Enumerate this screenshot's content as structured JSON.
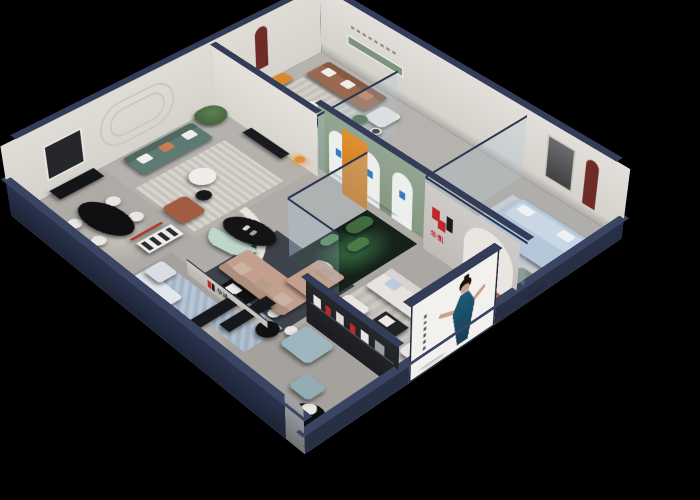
{
  "meta": {
    "description": "Isometric cutaway 3D rendering of a furniture showroom interior at night on a black background",
    "background": "#000000"
  },
  "brand": {
    "name": "华凯",
    "logo_mark": "stylized H of red and black blocks",
    "logo_red": "#c0272d",
    "logo_dark": "#1a1a1d"
  },
  "texts": {
    "brand": "华凯"
  },
  "palette": {
    "outer_wall_navy": "#272f45",
    "wall_top_navy": "#333d59",
    "interior_wall": "#ddd9d3",
    "floor_gray": "#a8a5a0",
    "green_arch_wall": "#8b9e8b",
    "maroon_niche": "#6f2b26",
    "accent_orange": "#e09030",
    "plant_green": "#4c6b45",
    "brown_leather": "#9a6a50",
    "tan_fabric": "#c2a08d",
    "teal_sofa": "#5f7a74",
    "terracotta_sofa": "#b0604a",
    "light_blue_bed": "#b5c8da",
    "cream_sofa": "#e7e4df",
    "glass": "rgba(172,198,216,0.24)"
  },
  "rooms": [
    {
      "name": "back-right lounge",
      "furniture": [
        "brown leather sofa",
        "white armchair",
        "orange accent chair",
        "round coffee tables",
        "plant",
        "green recessed wall shelf",
        "wall slogan"
      ]
    },
    {
      "name": "glass bedroom",
      "furniture": [
        "light blue upholstered bed",
        "dark bench",
        "glass partitions"
      ]
    },
    {
      "name": "back-left lounge",
      "furniture": [
        "caramel sectional sofa",
        "yellow pillow",
        "maroon arch niche with figurine",
        "black and white coffee table"
      ]
    },
    {
      "name": "teal lounge",
      "furniture": [
        "teal sofa",
        "rust armchair",
        "striped rug",
        "round white table",
        "plant",
        "wall moldings",
        "orange floor lamp"
      ]
    },
    {
      "name": "center lounge",
      "furniture": [
        "curved white partition",
        "black oval table",
        "mint bench",
        "tan sectional sofa",
        "black coffee table",
        "dark rug"
      ]
    },
    {
      "name": "cactus atrium",
      "furniture": [
        "glass enclosure",
        "cacti",
        "pebbles",
        "green glow"
      ]
    },
    {
      "name": "brand wall bay",
      "furniture": [
        "H logo wall",
        "terracotta sofa in arch",
        "round table with chairs",
        "green loveseat"
      ]
    },
    {
      "name": "front-right lounge",
      "furniture": [
        "cream sofa",
        "cream armchair",
        "white chaise",
        "product display wall",
        "black round rug",
        "white chair"
      ]
    },
    {
      "name": "front-left dining",
      "furniture": [
        "black oval dining table",
        "white chairs",
        "red floor lamp",
        "white shelving unit",
        "dark console"
      ]
    },
    {
      "name": "front gallery",
      "furniture": [
        "white corner sofa",
        "black benches",
        "round black table",
        "light blue sofa with ottoman",
        "blue rugs",
        "brand ledge"
      ]
    }
  ],
  "poster": {
    "location": "exterior front-right wall",
    "subject": "woman with dark hair in a teal dress",
    "dress_color": "#19506b",
    "panel_color": "#f2f1ee"
  }
}
